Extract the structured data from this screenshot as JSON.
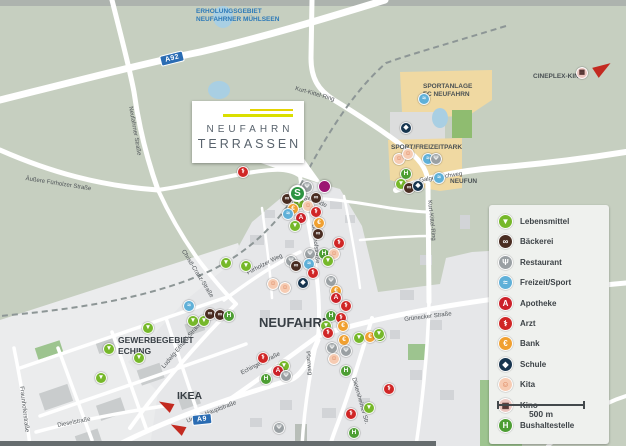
{
  "logo": {
    "line1": "NEUFAHRN",
    "line2": "TERRASSEN"
  },
  "scale": {
    "label": "500 m"
  },
  "legend": {
    "items": [
      {
        "id": "lebensmittel",
        "label": "Lebensmittel",
        "color": "#76b82a",
        "glyph": "▼",
        "glyph_color": "#ffffff"
      },
      {
        "id": "baeckerei",
        "label": "Bäckerei",
        "color": "#4a2d22",
        "glyph": "∞",
        "glyph_color": "#ffffff"
      },
      {
        "id": "restaurant",
        "label": "Restaurant",
        "color": "#9aa0a3",
        "glyph": "Ψ",
        "glyph_color": "#ffffff"
      },
      {
        "id": "freizeit",
        "label": "Freizeit/Sport",
        "color": "#5fb0d8",
        "glyph": "≈",
        "glyph_color": "#ffffff"
      },
      {
        "id": "apotheke",
        "label": "Apotheke",
        "color": "#cc2129",
        "glyph": "A",
        "glyph_color": "#ffffff"
      },
      {
        "id": "arzt",
        "label": "Arzt",
        "color": "#d02626",
        "glyph": "⚕",
        "glyph_color": "#ffffff"
      },
      {
        "id": "bank",
        "label": "Bank",
        "color": "#f0a030",
        "glyph": "€",
        "glyph_color": "#ffffff"
      },
      {
        "id": "schule",
        "label": "Schule",
        "color": "#17354f",
        "glyph": "◆",
        "glyph_color": "#ffffff"
      },
      {
        "id": "kita",
        "label": "Kita",
        "color": "#f6cbb2",
        "glyph": "☺",
        "glyph_color": "#d97c52"
      },
      {
        "id": "kino",
        "label": "Kino",
        "color": "#ecc6c0",
        "glyph": "▦",
        "glyph_color": "#4a2a28"
      },
      {
        "id": "bus",
        "label": "Bushaltestelle",
        "color": "#4d9e33",
        "glyph": "H",
        "glyph_color": "#ffffff"
      }
    ]
  },
  "special": {
    "sbahn": {
      "glyph": "S",
      "x": 289,
      "y": 185
    },
    "site": {
      "x": 318,
      "y": 180
    }
  },
  "badges": [
    {
      "id": "a92",
      "text": "A92",
      "x": 160,
      "y": 53,
      "rot": -14
    },
    {
      "id": "a9",
      "text": "A9",
      "x": 192,
      "y": 414,
      "rot": -6
    }
  ],
  "arrows": [
    {
      "id": "ikea-arrow-1",
      "dir": "sw",
      "x": 158,
      "y": 400,
      "rot": 28
    },
    {
      "id": "ikea-arrow-2",
      "dir": "sw",
      "x": 170,
      "y": 423,
      "rot": 28
    },
    {
      "id": "cineplex-arrow",
      "dir": "ne",
      "x": 594,
      "y": 62,
      "rot": -33
    }
  ],
  "area_labels": [
    {
      "id": "erholungsgebiet",
      "lines": [
        "ERHOLUNGSGEBIET",
        "NEUFAHRNER MÜHLSEEN"
      ],
      "x": 196,
      "y": 8,
      "color": "#2d7ab8",
      "size": 6.5
    },
    {
      "id": "sportanlage",
      "lines": [
        "SPORTANLAGE",
        "FC NEUFAHRN"
      ],
      "x": 423,
      "y": 83,
      "color": "#4a5154",
      "size": 6.5
    },
    {
      "id": "sport-freizeitpark",
      "lines": [
        "SPORT/FREIZEITPARK"
      ],
      "x": 391,
      "y": 144,
      "color": "#4a5154",
      "size": 6.5
    },
    {
      "id": "neufun",
      "lines": [
        "NEUFUN"
      ],
      "x": 450,
      "y": 178,
      "color": "#4a5154",
      "size": 6.5
    },
    {
      "id": "cineplex-kino",
      "lines": [
        "CINEPLEX-KINO"
      ],
      "x": 533,
      "y": 73,
      "color": "#4a5154",
      "size": 6.5
    },
    {
      "id": "neufahrn",
      "lines": [
        "NEUFAHRN"
      ],
      "x": 259,
      "y": 315,
      "color": "#383f45",
      "size": 13
    },
    {
      "id": "gewerbegebiet-eching",
      "lines": [
        "GEWERBEGEBIET",
        "ECHING"
      ],
      "x": 118,
      "y": 335,
      "color": "#383f45",
      "size": 8.5
    },
    {
      "id": "ikea",
      "lines": [
        "IKEA"
      ],
      "x": 177,
      "y": 390,
      "color": "#383f45",
      "size": 10.5
    }
  ],
  "street_labels": [
    {
      "id": "kurt-kittel-ring-top",
      "text": "Kurt-Kittel-Ring",
      "x": 296,
      "y": 86,
      "rot": 16
    },
    {
      "id": "kurt-kittel-ring-east",
      "text": "Kurt-Kittel-Ring",
      "x": 432,
      "y": 200,
      "rot": 84
    },
    {
      "id": "neufahrner-strasse",
      "text": "Neufahrner Straße",
      "x": 133,
      "y": 106,
      "rot": 80
    },
    {
      "id": "aeussere-fuerholzer-strasse",
      "text": "Äußere Fürholzer Straße",
      "x": 26,
      "y": 176,
      "rot": 9
    },
    {
      "id": "christl-cranz-strasse",
      "text": "Christl-Cranz-Straße",
      "x": 185,
      "y": 249,
      "rot": 58
    },
    {
      "id": "fuerholzer-weg",
      "text": "Fürholzer Weg",
      "x": 246,
      "y": 271,
      "rot": -27
    },
    {
      "id": "bahnhofstrasse",
      "text": "Bahnhofstraße",
      "x": 316,
      "y": 224,
      "rot": 84
    },
    {
      "id": "vogelweide",
      "text": "Vogelweide",
      "x": 299,
      "y": 192,
      "rot": 22
    },
    {
      "id": "galgenbachweg",
      "text": "Galgenbachweg",
      "x": 419,
      "y": 178,
      "rot": -9
    },
    {
      "id": "gruenecker-strasse",
      "text": "Grünecker Straße",
      "x": 404,
      "y": 317,
      "rot": -7
    },
    {
      "id": "echinger-strasse",
      "text": "Echinger Straße",
      "x": 240,
      "y": 371,
      "rot": -27
    },
    {
      "id": "pfarrweg",
      "text": "Pfarrweg",
      "x": 310,
      "y": 351,
      "rot": 84
    },
    {
      "id": "dietersheimer-str",
      "text": "Dietersheimer Str.",
      "x": 356,
      "y": 377,
      "rot": 74
    },
    {
      "id": "untere-hauptstrasse",
      "text": "Untere Hauptstraße",
      "x": 186,
      "y": 419,
      "rot": -21
    },
    {
      "id": "ludwig-erhard-strasse",
      "text": "Ludwig-Erhard-Straße",
      "x": 161,
      "y": 366,
      "rot": -50
    },
    {
      "id": "dieselstrasse",
      "text": "Dieselstraße",
      "x": 57,
      "y": 423,
      "rot": -11
    },
    {
      "id": "fraunhoferstrasse",
      "text": "Fraunhoferstraße",
      "x": 24,
      "y": 386,
      "rot": 83
    }
  ],
  "markers": [
    {
      "t": "restaurant",
      "x": 306,
      "y": 186
    },
    {
      "t": "baeckerei",
      "x": 286,
      "y": 198
    },
    {
      "t": "lebensmittel",
      "x": 298,
      "y": 202
    },
    {
      "t": "baeckerei",
      "x": 315,
      "y": 197
    },
    {
      "t": "kita",
      "x": 307,
      "y": 205
    },
    {
      "t": "bank",
      "x": 292,
      "y": 208
    },
    {
      "t": "freizeit",
      "x": 287,
      "y": 213
    },
    {
      "t": "apotheke",
      "x": 300,
      "y": 217
    },
    {
      "t": "arzt",
      "x": 315,
      "y": 211
    },
    {
      "t": "bank",
      "x": 318,
      "y": 222
    },
    {
      "t": "lebensmittel",
      "x": 294,
      "y": 225
    },
    {
      "t": "baeckerei",
      "x": 317,
      "y": 233
    },
    {
      "t": "arzt",
      "x": 338,
      "y": 242
    },
    {
      "t": "restaurant",
      "x": 309,
      "y": 253
    },
    {
      "t": "bus",
      "x": 323,
      "y": 253
    },
    {
      "t": "kita",
      "x": 333,
      "y": 253
    },
    {
      "t": "restaurant",
      "x": 290,
      "y": 260
    },
    {
      "t": "baeckerei",
      "x": 295,
      "y": 265
    },
    {
      "t": "freizeit",
      "x": 308,
      "y": 263
    },
    {
      "t": "lebensmittel",
      "x": 327,
      "y": 260
    },
    {
      "t": "arzt",
      "x": 312,
      "y": 272
    },
    {
      "t": "schule",
      "x": 302,
      "y": 282
    },
    {
      "t": "kita",
      "x": 272,
      "y": 283
    },
    {
      "t": "kita",
      "x": 284,
      "y": 287
    },
    {
      "t": "restaurant",
      "x": 330,
      "y": 280
    },
    {
      "t": "bank",
      "x": 335,
      "y": 290
    },
    {
      "t": "apotheke",
      "x": 335,
      "y": 297
    },
    {
      "t": "arzt",
      "x": 345,
      "y": 305
    },
    {
      "t": "bus",
      "x": 330,
      "y": 315
    },
    {
      "t": "arzt",
      "x": 340,
      "y": 317
    },
    {
      "t": "lebensmittel",
      "x": 325,
      "y": 325
    },
    {
      "t": "bank",
      "x": 342,
      "y": 325
    },
    {
      "t": "arzt",
      "x": 327,
      "y": 332
    },
    {
      "t": "bank",
      "x": 343,
      "y": 339
    },
    {
      "t": "lebensmittel",
      "x": 358,
      "y": 337
    },
    {
      "t": "bank",
      "x": 369,
      "y": 336
    },
    {
      "t": "lebensmittel",
      "x": 379,
      "y": 335
    },
    {
      "t": "restaurant",
      "x": 331,
      "y": 347
    },
    {
      "t": "restaurant",
      "x": 345,
      "y": 350
    },
    {
      "t": "kita",
      "x": 333,
      "y": 358
    },
    {
      "t": "bus",
      "x": 345,
      "y": 370
    },
    {
      "t": "lebensmittel",
      "x": 245,
      "y": 265
    },
    {
      "t": "lebensmittel",
      "x": 225,
      "y": 262
    },
    {
      "t": "freizeit",
      "x": 188,
      "y": 305
    },
    {
      "t": "lebensmittel",
      "x": 192,
      "y": 320
    },
    {
      "t": "lebensmittel",
      "x": 203,
      "y": 320
    },
    {
      "t": "baeckerei",
      "x": 209,
      "y": 313
    },
    {
      "t": "baeckerei",
      "x": 219,
      "y": 314
    },
    {
      "t": "bus",
      "x": 228,
      "y": 315
    },
    {
      "t": "lebensmittel",
      "x": 147,
      "y": 327
    },
    {
      "t": "lebensmittel",
      "x": 108,
      "y": 348
    },
    {
      "t": "lebensmittel",
      "x": 138,
      "y": 357
    },
    {
      "t": "lebensmittel",
      "x": 100,
      "y": 377
    },
    {
      "t": "arzt",
      "x": 262,
      "y": 357
    },
    {
      "t": "lebensmittel",
      "x": 283,
      "y": 365
    },
    {
      "t": "apotheke",
      "x": 277,
      "y": 370
    },
    {
      "t": "restaurant",
      "x": 285,
      "y": 375
    },
    {
      "t": "bus",
      "x": 265,
      "y": 378
    },
    {
      "t": "arzt",
      "x": 388,
      "y": 388
    },
    {
      "t": "lebensmittel",
      "x": 368,
      "y": 407
    },
    {
      "t": "arzt",
      "x": 350,
      "y": 413
    },
    {
      "t": "bus",
      "x": 353,
      "y": 432
    },
    {
      "t": "restaurant",
      "x": 278,
      "y": 427
    },
    {
      "t": "freizeit",
      "x": 423,
      "y": 98
    },
    {
      "t": "schule",
      "x": 405,
      "y": 127
    },
    {
      "t": "kita",
      "x": 398,
      "y": 158
    },
    {
      "t": "kita",
      "x": 407,
      "y": 153
    },
    {
      "t": "freizeit",
      "x": 427,
      "y": 158
    },
    {
      "t": "restaurant",
      "x": 435,
      "y": 158
    },
    {
      "t": "freizeit",
      "x": 438,
      "y": 177
    },
    {
      "t": "bus",
      "x": 405,
      "y": 173
    },
    {
      "t": "lebensmittel",
      "x": 400,
      "y": 183
    },
    {
      "t": "baeckerei",
      "x": 408,
      "y": 187
    },
    {
      "t": "schule",
      "x": 417,
      "y": 185
    },
    {
      "t": "kino",
      "x": 581,
      "y": 72
    },
    {
      "t": "lebensmittel",
      "x": 378,
      "y": 333
    },
    {
      "t": "arzt",
      "x": 242,
      "y": 171
    }
  ]
}
